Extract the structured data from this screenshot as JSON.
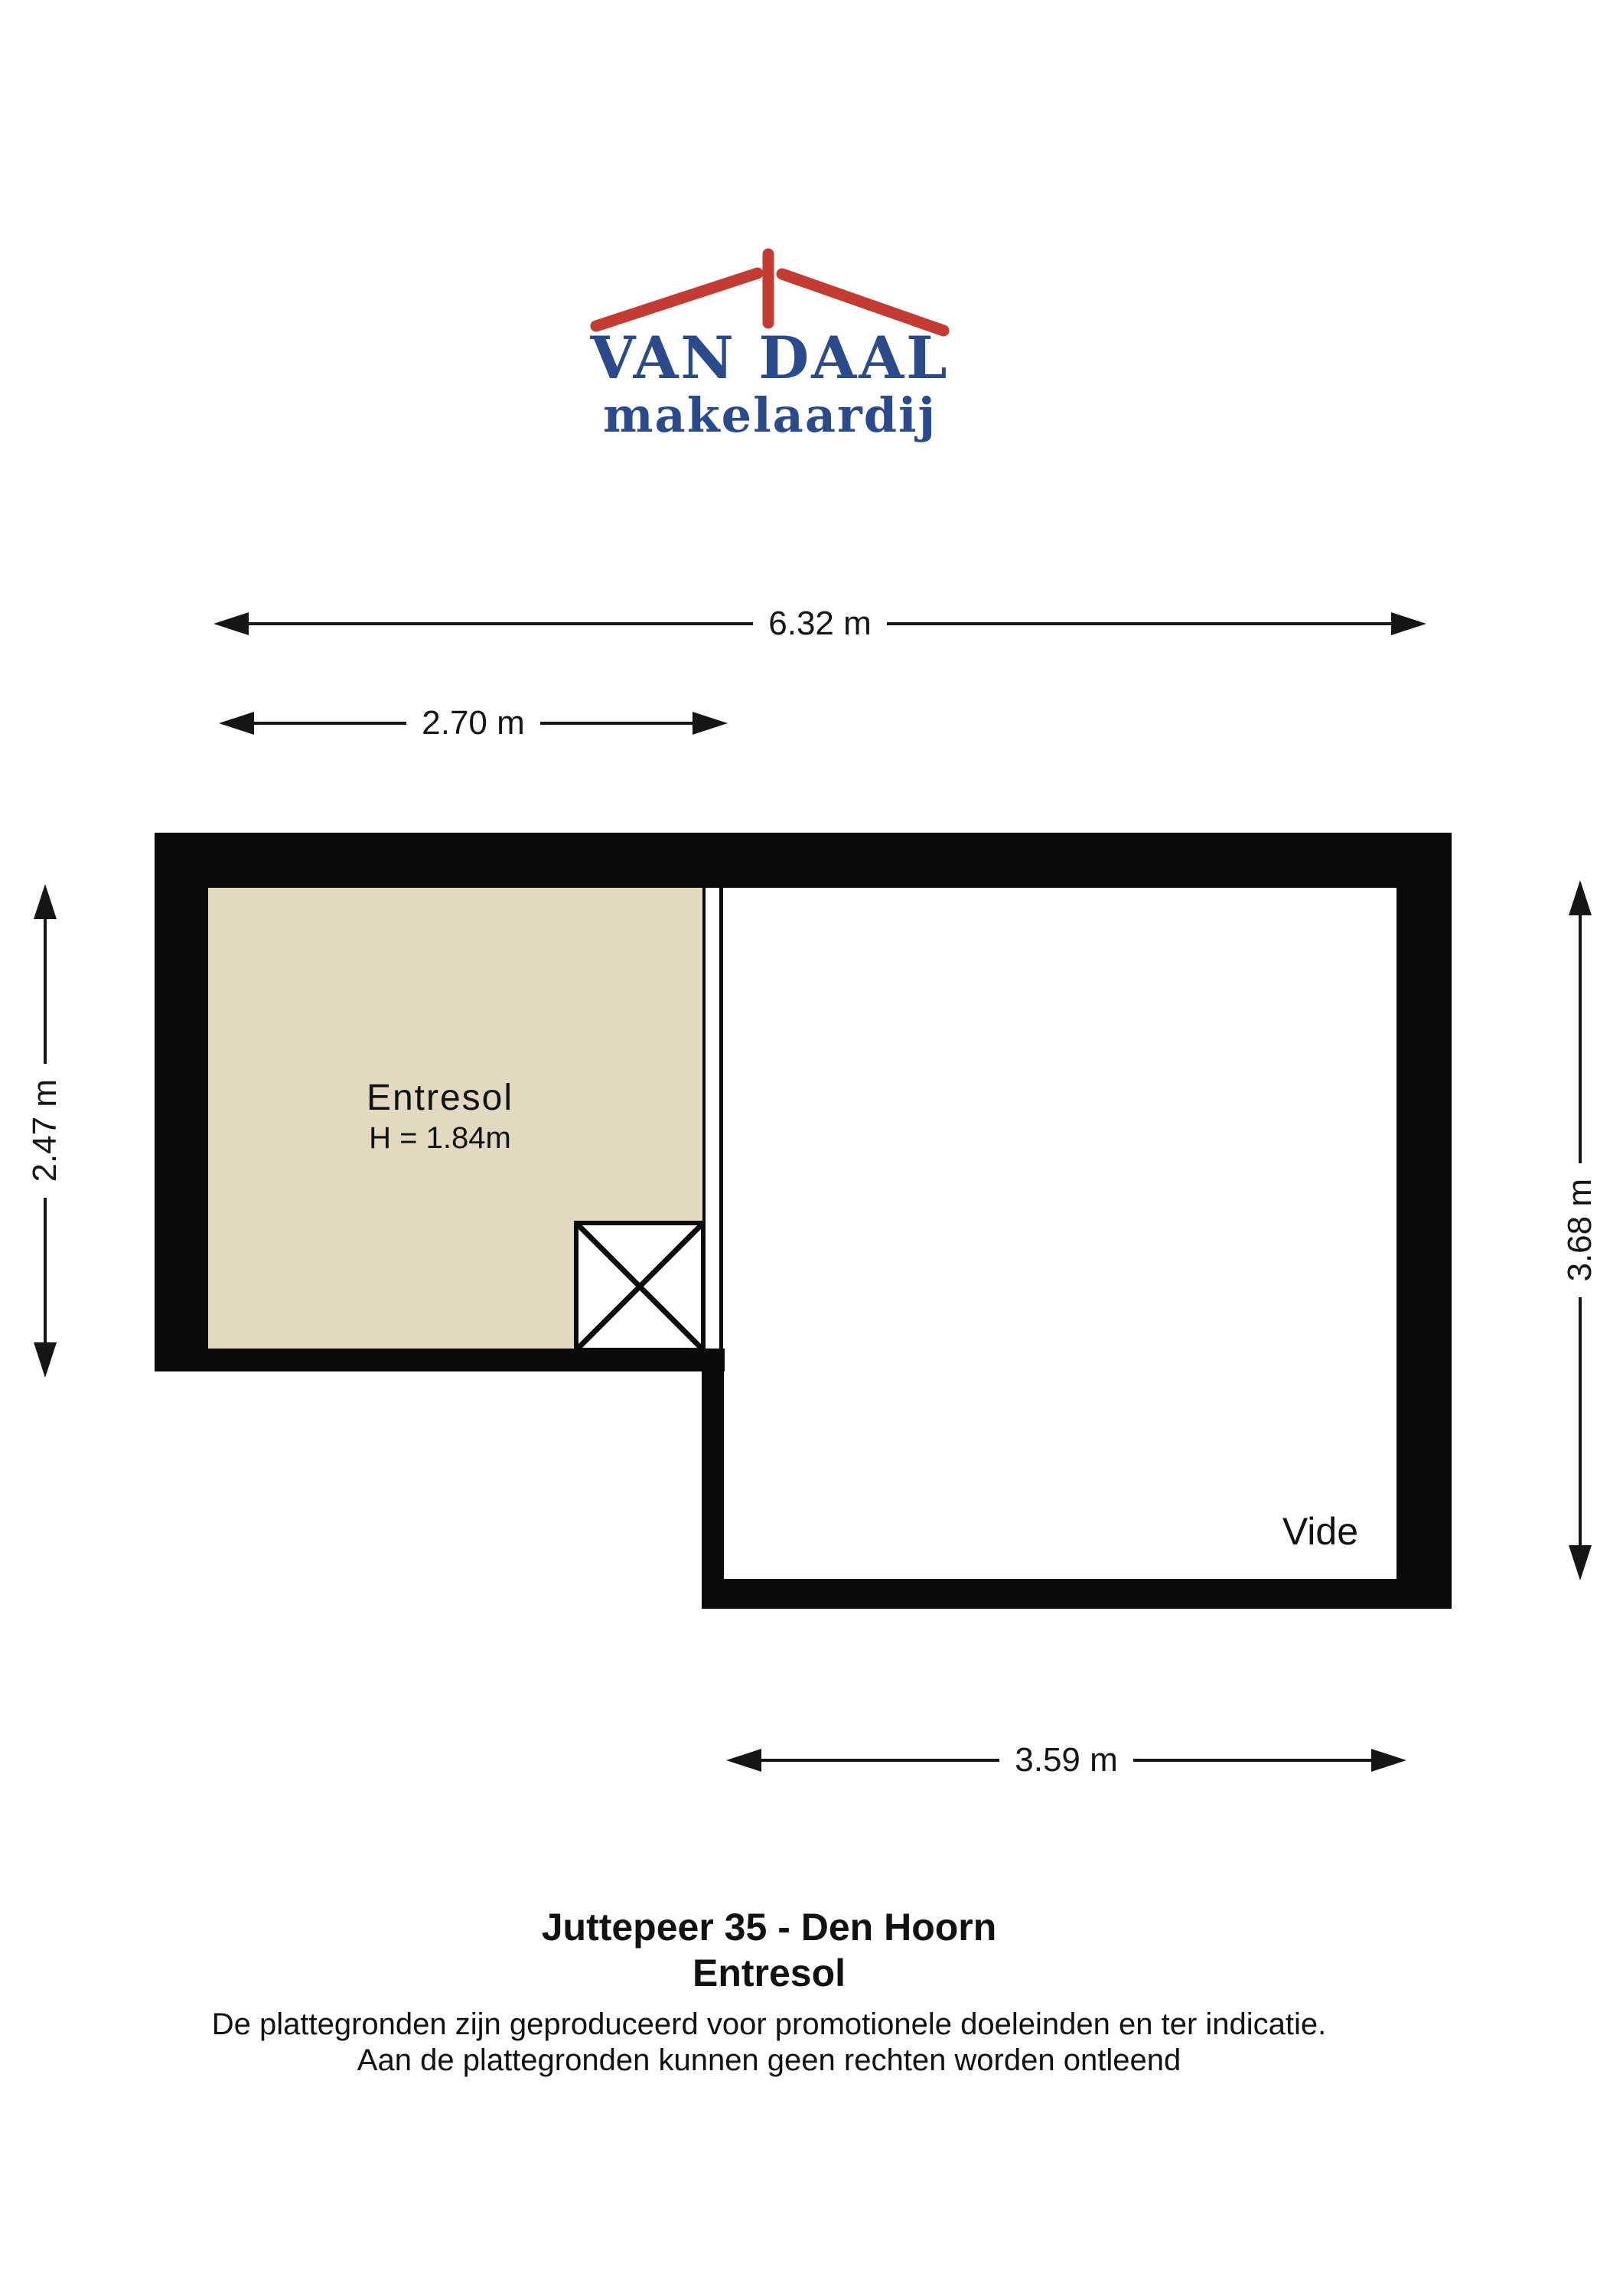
{
  "logo": {
    "wordmark": "VAN DAAL",
    "subtitle": "makelaardij"
  },
  "colors": {
    "brand_blue": "#2B4A8C",
    "brand_red": "#C33B32",
    "room_fill": "#E3D9C1",
    "wall": "#0A0A0A"
  },
  "dimensions": {
    "top_width": "6.32 m",
    "entresol_width": "2.70 m",
    "entresol_depth": "2.47 m",
    "vide_depth": "3.68 m",
    "vide_width": "3.59 m"
  },
  "rooms": {
    "entresol": {
      "label": "Entresol",
      "height_note": "H = 1.84m"
    },
    "vide": {
      "label": "Vide"
    }
  },
  "footer": {
    "address": "Juttepeer 35 - Den Hoorn",
    "floor": "Entresol",
    "disclaimer_line1": "De plattegronden zijn geproduceerd voor promotionele doeleinden en ter indicatie.",
    "disclaimer_line2": "Aan de plattegronden kunnen geen rechten worden ontleend"
  }
}
